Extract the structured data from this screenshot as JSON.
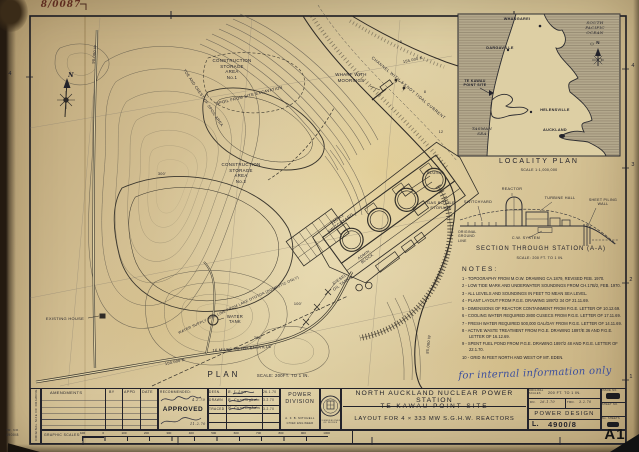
{
  "scan": {
    "file_number": "8/0087",
    "sheet_mark": "A1",
    "handwritten_note": "for internal information only",
    "side_strip_text": "ORIGINAL SIZE OF DRAWING",
    "tr_label": "TR. NO.",
    "tr_value": "4900/8",
    "margin_left_number": "4",
    "margin_right_1": "4",
    "margin_right_2": "3",
    "margin_right_3": "2",
    "margin_right_4": "1"
  },
  "map": {
    "plan_title": "PLAN",
    "plan_scale": "SCALE: 200FT. TO 1 IN.",
    "north": "N",
    "construction_area_1": "CONSTRUCTION\nSTORAGE\nAREA\nNo.1",
    "construction_area_2": "CONSTRUCTION\nSTORAGE\nAREA\nNo.2",
    "wharf": "WHARF WITH\nMOORINGS",
    "channel": "CHANNEL WITH 2 KNOT TIDAL CURRENT",
    "spoil": "SPOIL FROM SITE EXCAVATION",
    "spoil_crest": "TOE AND CREST OF SPOIL AREA",
    "existing_house": "EXISTING HOUSE",
    "water_tank": "WATER\nTANK",
    "switchyard": "220 KV\nSWITCHYARD",
    "diesel_tanks": "DIESEL\nOIL TANKS",
    "gas_bottle": "GAS BOTTLE\nSTORAGE",
    "sluice": "SLUICE",
    "admin": "ADMIN.\nBLOCK",
    "road_helensville": "16 MILES TO HELENSVILLE",
    "pipeline": "WATER SUPPLY PIPE LINE FROM LAKE OTOTOA (DOMESTIC ONLY)",
    "grid_n_155": "155.000 N",
    "grid_n_150": "150.000 N",
    "grid_w_90": "90.000 W",
    "grid_w_85": "85.000 W",
    "contour_100": "100'",
    "contour_200": "200'",
    "contour_300": "300'",
    "sounding_1": "5",
    "sounding_2": "8",
    "sounding_3": "12"
  },
  "locality": {
    "title": "LOCALITY PLAN",
    "scale": "SCALE 1:1,000,000",
    "whangarei": "WHANGAREI",
    "dargaville": "DARGAVILLE",
    "site": "TE KAWAU\nPOINT SITE",
    "helensville": "HELENSVILLE",
    "auckland": "AUCKLAND",
    "pacific": "SOUTH\nPACIFIC\nOCEAN",
    "tasman": "TASMAN\nSEA",
    "north": "N"
  },
  "section": {
    "title": "SECTION THROUGH STATION (A-A)",
    "scale": "SCALE: 200 FT. TO 1 IN.",
    "switchyard": "SWITCHYARD",
    "reactor": "REACTOR",
    "turbine_hall": "TURBINE HALL",
    "sheet_piling": "SHEET PILING\nWALL",
    "ground_line": "ORIGINAL\nGROUND\nLINE",
    "cw_system": "C.W. SYSTEM"
  },
  "notes": {
    "heading": "NOTES:",
    "items": [
      "1 - TOPOGRAPHY FROM M.O.W. DRAWING CA.1879, REVISED FEB. 1970.",
      "2 - LOW TIDE MARK AND UNDERWATER SOUNDINGS FROM CH.17B/2, FEB. 1970.",
      "3 - ALL LEVELS AND SOUNDINGS IN FEET TO MEAN SEA LEVEL.",
      "4 - PLANT LAYOUT FROM P.G.E. DRAWING 1897/2 34 OF 21.11.69.",
      "5 - DIMENSIONS OF REACTOR CONTAINMENT FROM P.G.E. LETTER OF 10.12.69.",
      "6 - COOLING WATER REQUIRED 2800 CUSECS FROM P.G.E. LETTER OF 17.11.69.",
      "7 - FRESH WATER REQUIRED 500,000 GAL/DAY FROM P.G.E. LETTER OF 14.11.69.",
      "8 - ACTIVE WASTE TREATMENT FROM P.G.E. DRAWING 1897/E 36 AND P.G.E. LETTER OF 16.12.69.",
      "9 - SPENT FUEL POND FROM P.G.E. DRAWING 1897/2 48 AND P.G.E. LETTER OF 22.1.70.",
      "10 - GRID IN FEET NORTH AND WEST OF MT. EDEN."
    ]
  },
  "title_block": {
    "amendments": "AMENDMENTS",
    "col_by": "BY",
    "col_appd": "APPD",
    "col_date": "DATE",
    "recommended": "RECOMMENDED:",
    "recommended_date": "4.2.70",
    "approved": "APPROVED",
    "approved_date": "11.2.70",
    "row1_role": "DESN.",
    "row1_name": "R. J. Law",
    "row1_date": "26.1.70",
    "row2_role": "DRAWN",
    "row2_name": "R. Cunningham",
    "row2_date": "3.2.70",
    "row3_role": "TRACED",
    "row3_name": "N. Cunningham",
    "row3_date": "3.2.70",
    "division": "POWER\nDIVISION",
    "officer_name": "A. F. B. MITCHELL",
    "officer_title": "CHIEF ENGINEER",
    "crest_caption": "COMMISSIONER OF WORKS",
    "station_title": "NORTH AUCKLAND NUCLEAR POWER STATION",
    "site_title": "TE KAWAU POINT SITE",
    "layout_title": "LAYOUT FOR 4 × 333 MW S.G.H.W. REACTORS",
    "original_scales_label": "ORIGINAL\nSCALES",
    "original_scales_value": "200 FT. TO 1 IN.",
    "dn_label": "DN.",
    "dn_value": "26.1.70",
    "trd_label": "TRD.",
    "trd_value": "3.2.70",
    "office_name": "POWER DESIGN",
    "series_letter": "L.",
    "drawing_number": "4900/8",
    "issue_label": "ISSUE NO.",
    "sheet_label": "SHEET NO.",
    "sheets_label": "No. SHEETS",
    "graphic_label": "GRAPHIC SCALES:",
    "scale_ticks": [
      "100",
      "0",
      "100",
      "200",
      "300",
      "400",
      "500",
      "600",
      "700",
      "800",
      "900",
      "1000"
    ]
  }
}
